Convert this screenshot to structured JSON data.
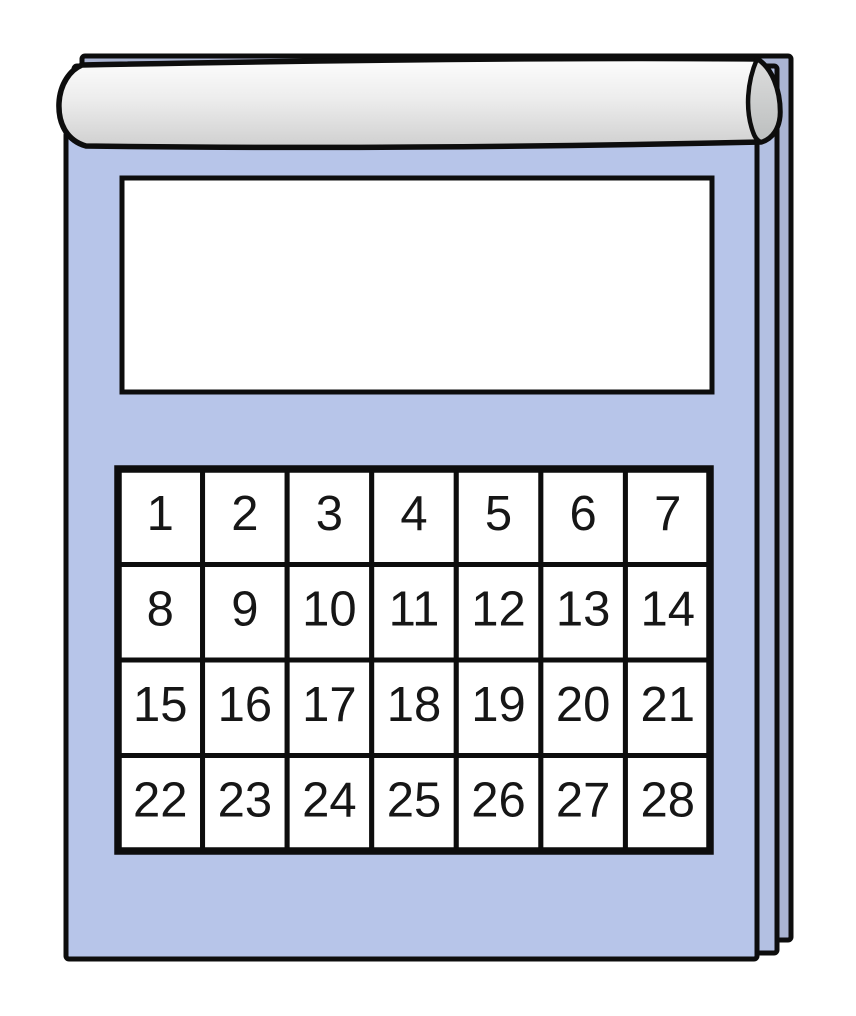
{
  "calendar": {
    "title": "",
    "days": [
      "1",
      "2",
      "3",
      "4",
      "5",
      "6",
      "7",
      "8",
      "9",
      "10",
      "11",
      "12",
      "13",
      "14",
      "15",
      "16",
      "17",
      "18",
      "19",
      "20",
      "21",
      "22",
      "23",
      "24",
      "25",
      "26",
      "27",
      "28"
    ],
    "grid": {
      "rows": 4,
      "columns": 7
    },
    "colors": {
      "background": "#ffffff",
      "page": "#b7c5e9",
      "page_edge_mid": "#b3c0e2",
      "page_edge_back": "#aab4d2",
      "cell_fill": "#ffffff",
      "outline": "#0d0d0d",
      "number_color": "#161616",
      "bar_light": "#fdfdfd",
      "bar_mid": "#ededed",
      "bar_dark": "#cfcfcf",
      "bar_cap_light": "#dedede",
      "bar_cap_dark": "#b9bcbc"
    }
  }
}
